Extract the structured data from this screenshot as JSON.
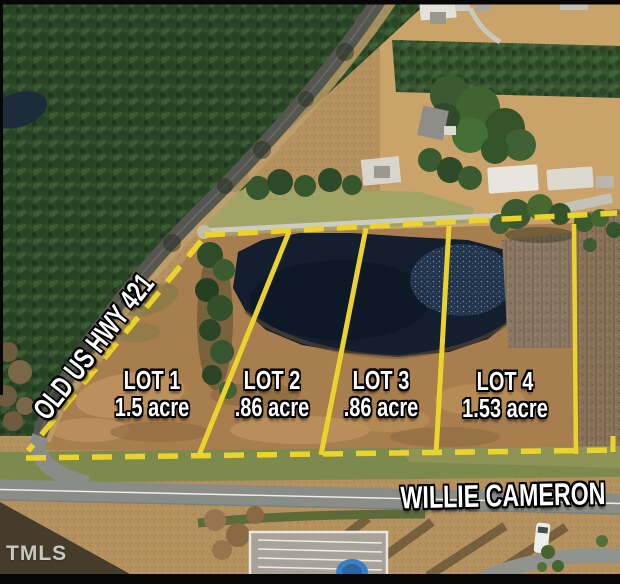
{
  "listing": {
    "lots": [
      {
        "name": "LOT 1",
        "acreage": "1.5 acre"
      },
      {
        "name": "LOT 2",
        "acreage": ".86 acre"
      },
      {
        "name": "LOT 3",
        "acreage": ".86 acre"
      },
      {
        "name": "LOT 4",
        "acreage": "1.53 acre"
      }
    ],
    "roads": {
      "highway_label": "OLD US HWY 421",
      "street_label": "WILLIE CAMERON"
    },
    "watermark": "TMLS",
    "colors": {
      "boundary_yellow": "#ecd32b",
      "label_text": "#ffffff",
      "label_outline": "#000000",
      "pond_water": "#131e2e"
    }
  }
}
